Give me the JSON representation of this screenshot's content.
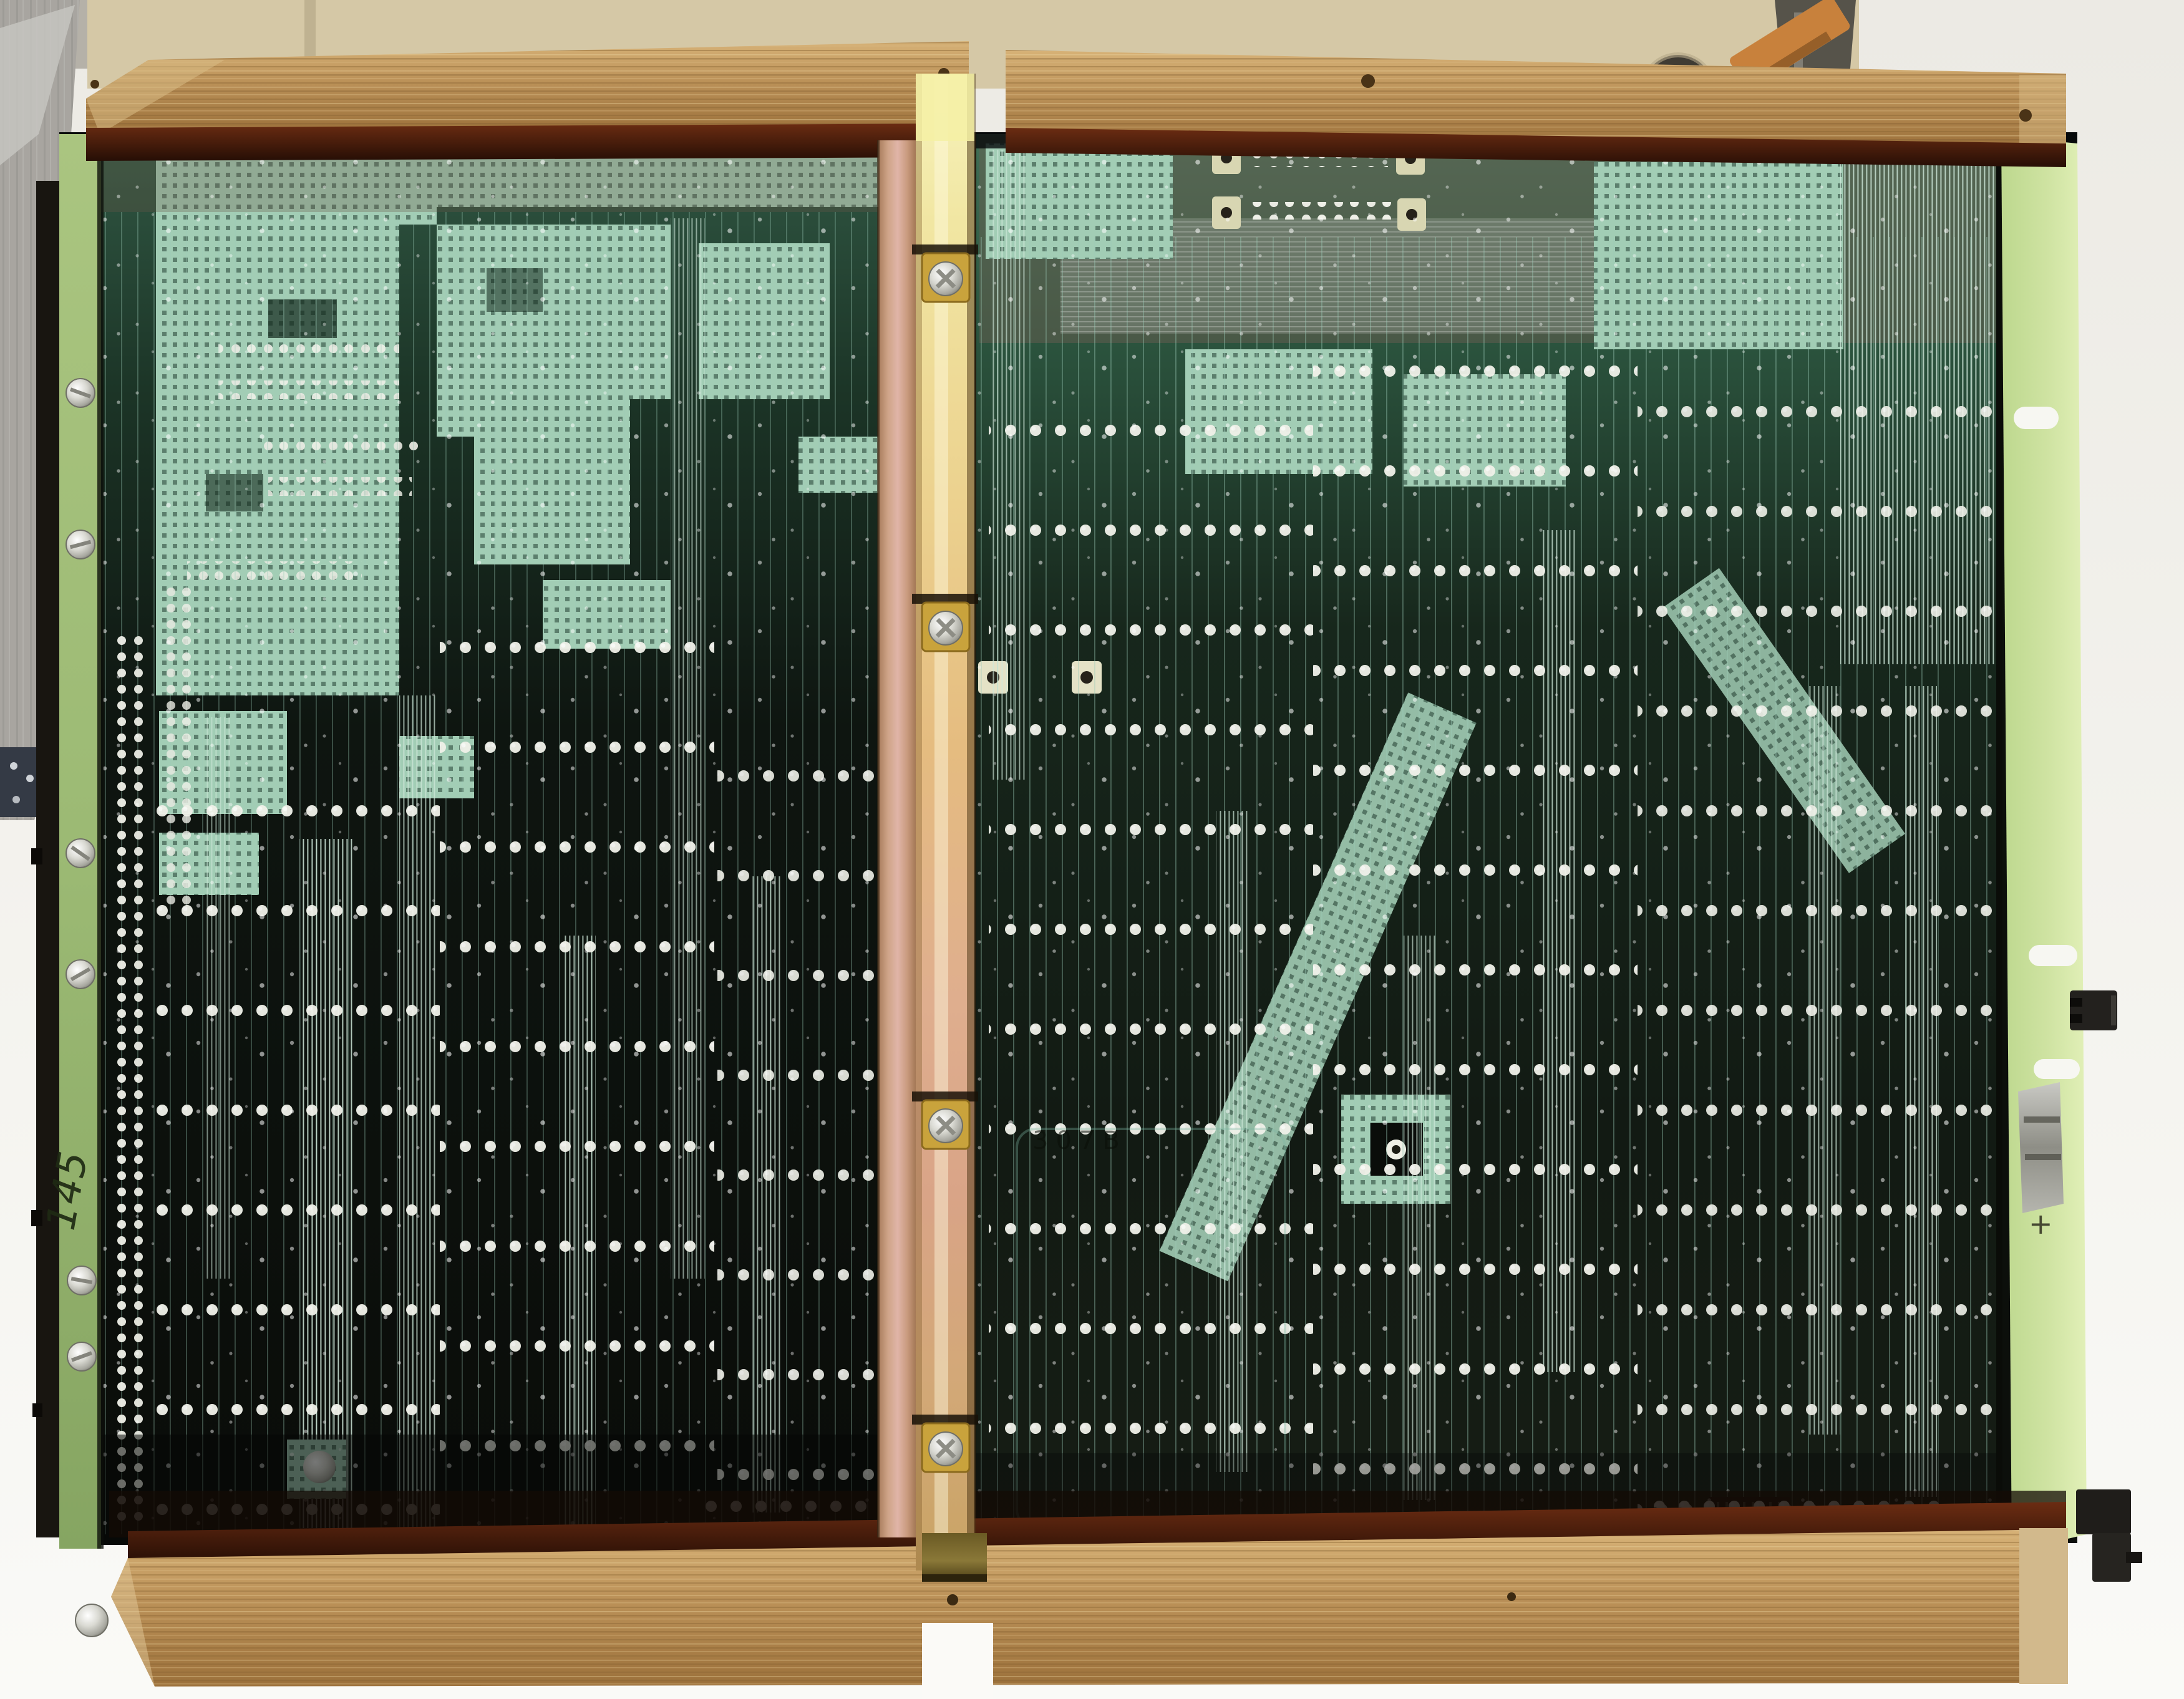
{
  "markings": {
    "handwritten_left_edge": "145",
    "etched_center": "307B",
    "etched_right_edge": "+"
  },
  "colors": {
    "background": "#f2f1ec",
    "machine_beige": "#d5c8a6",
    "wall_grey": "#b5b1a8",
    "ribbon_grey": "#a8a5a0",
    "ribbon_connector": "#343a45",
    "wood_light": "#d7b277",
    "wood_mid": "#bb9158",
    "wood_dark": "#9c713b",
    "stain_brown": "#6b2c12",
    "board_dark": "#0c0f0b",
    "copper_hatch": "#a2cdb5",
    "hatch_hole": "#223f31",
    "trace_teal": "#9ccbb8",
    "trace_bright": "#cfe8da",
    "pad_silver": "#f0f1e9",
    "bracket_brass_light": "#f7f3bc",
    "bracket_brass_mid": "#e5bc80",
    "bracket_rose": "#e0b5a8",
    "edge_green_left": "#9cba74",
    "edge_green_right": "#cfe3a2",
    "washer_gold": "#c9a33c",
    "copper_clip": "#c8813c",
    "connector_black": "#23211e",
    "mount_pad_cream": "#d8d6b2"
  }
}
